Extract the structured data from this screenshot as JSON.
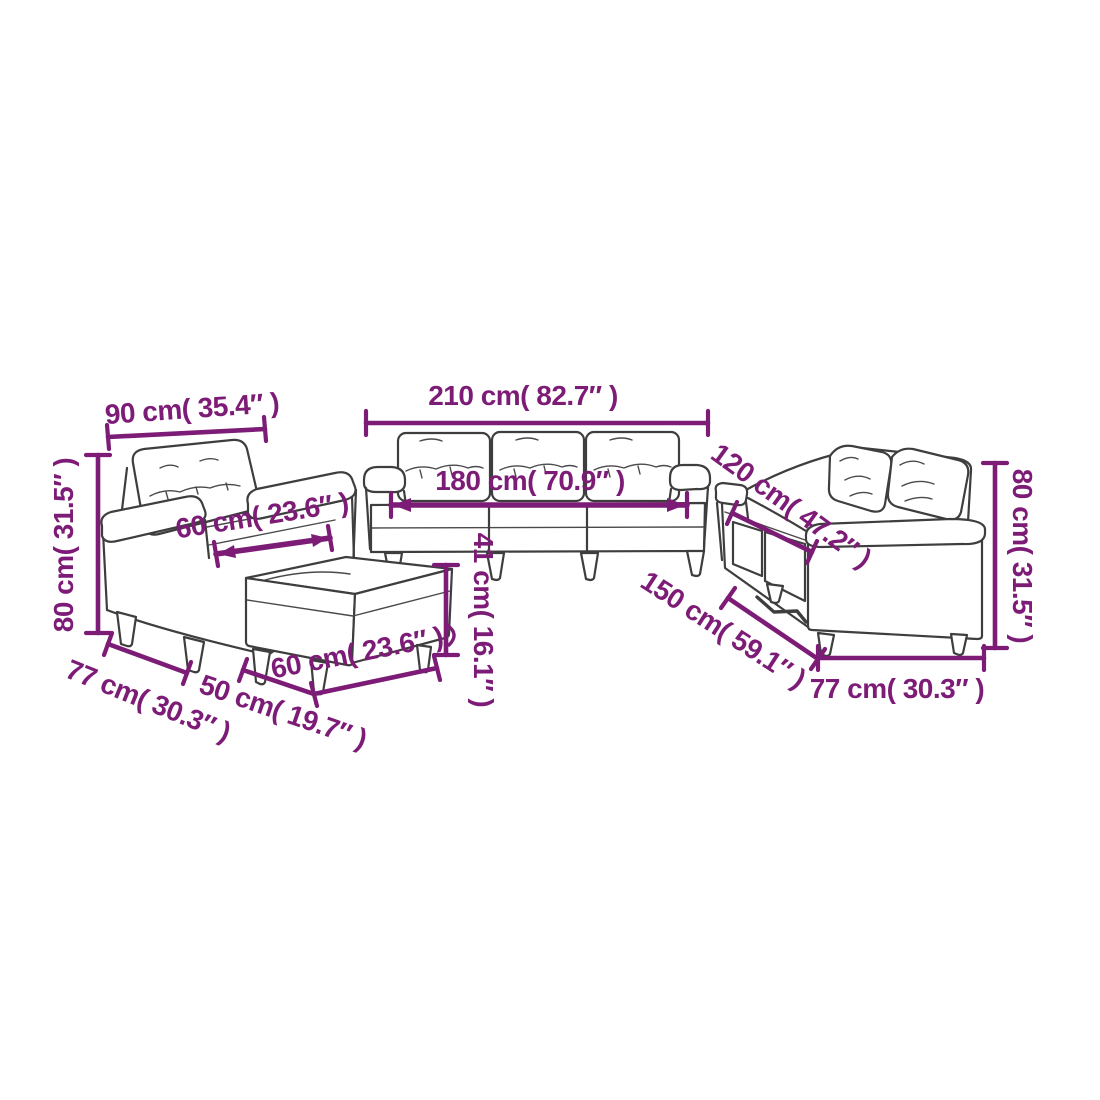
{
  "diagram": {
    "type": "furniture-dimension-diagram",
    "units": [
      "cm",
      "inches"
    ],
    "style": {
      "background": "#ffffff",
      "accent_color": "#7d1c77",
      "line_art_color": "#3e3e3e"
    }
  },
  "furniture": {
    "armchair": {
      "width": "90 cm( 35.4″ )",
      "height": "80 cm( 31.5″ )",
      "seat_width": "60 cm( 23.6″ )",
      "depth": "77 cm( 30.3″ )"
    },
    "footstool": {
      "width": "50 cm( 19.7″ )",
      "depth": "60 cm( 23.6″ )",
      "height": "41 cm( 16.1″ )"
    },
    "sofa_3_seater": {
      "width": "210 cm( 82.7″ )",
      "seat_width": "180 cm( 70.9″ )"
    },
    "sofa_2_seater": {
      "width": "120 cm( 47.2″ )",
      "total_width": "150 cm( 59.1″ )",
      "height": "80 cm( 31.5″ )",
      "depth": "77 cm( 30.3″ )"
    }
  }
}
